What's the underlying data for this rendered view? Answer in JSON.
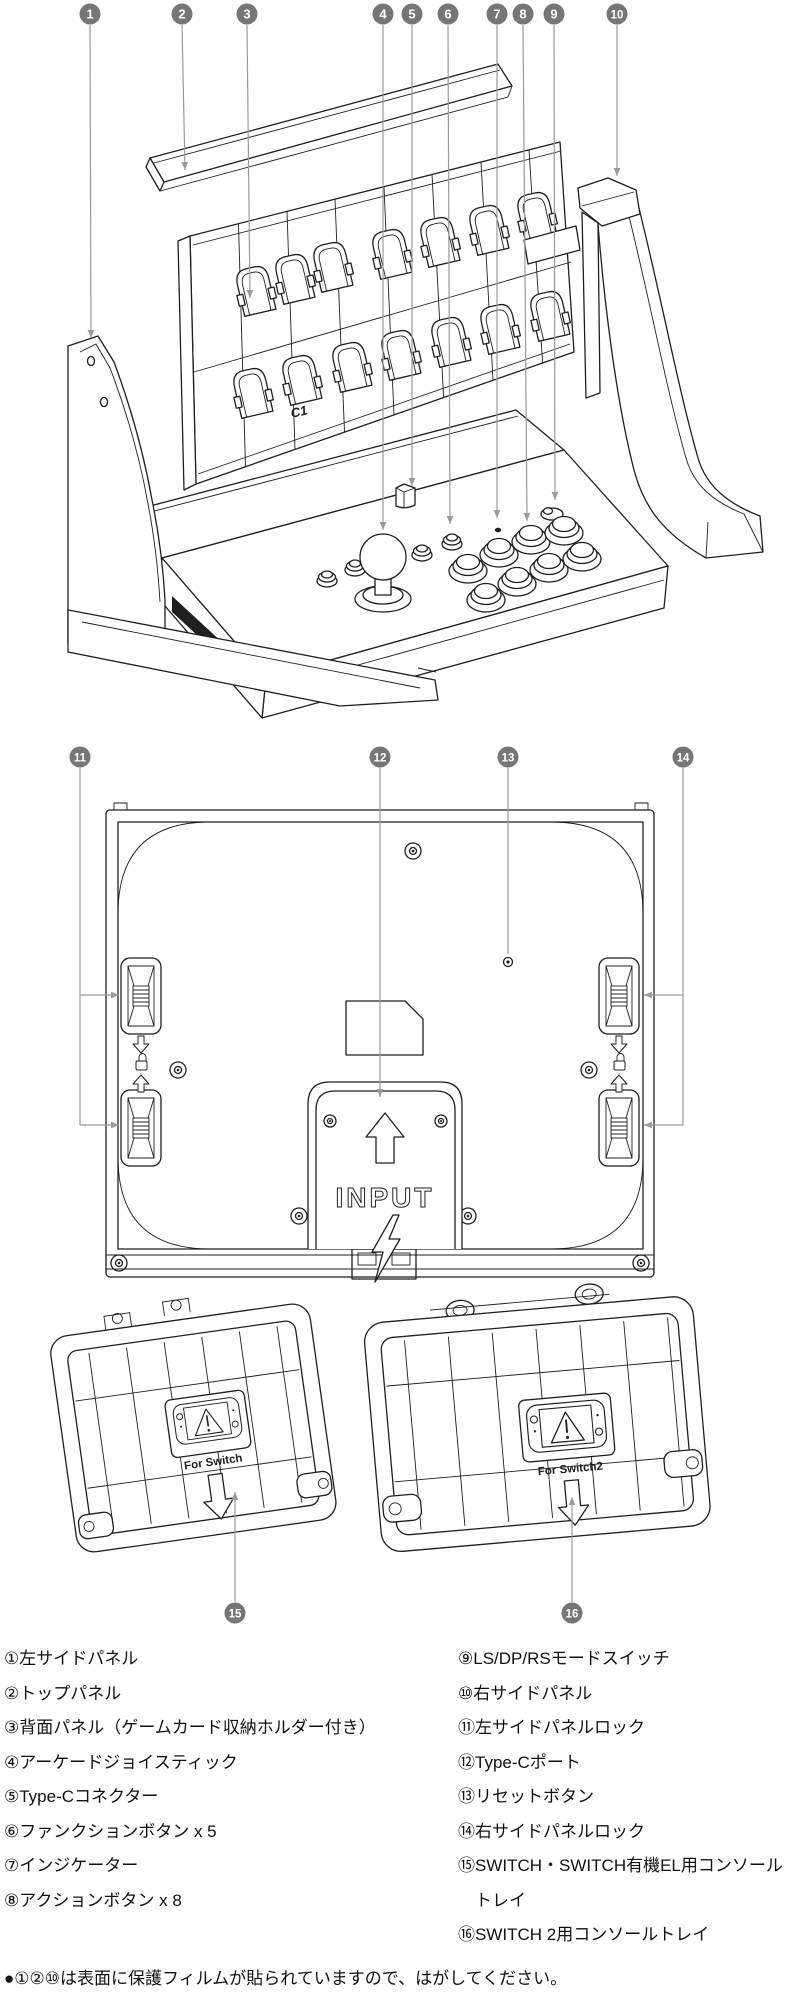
{
  "colors": {
    "ink": "#1f1f1f",
    "callout_fill": "#767676",
    "leader": "#9b9b9b",
    "bg": "#ffffff"
  },
  "fig_exploded": {
    "card_label": "C1",
    "callouts": [
      {
        "n": "1",
        "cx": 90,
        "cy": 14,
        "line": [
          [
            90,
            25
          ],
          [
            91,
            338
          ]
        ]
      },
      {
        "n": "2",
        "cx": 182,
        "cy": 14,
        "line": [
          [
            182,
            25
          ],
          [
            185,
            170
          ]
        ]
      },
      {
        "n": "3",
        "cx": 247,
        "cy": 14,
        "line": [
          [
            247,
            25
          ],
          [
            250,
            298
          ]
        ]
      },
      {
        "n": "4",
        "cx": 383,
        "cy": 14,
        "line": [
          [
            383,
            25
          ],
          [
            383,
            530
          ]
        ]
      },
      {
        "n": "5",
        "cx": 412,
        "cy": 14,
        "line": [
          [
            412,
            25
          ],
          [
            412,
            486
          ]
        ]
      },
      {
        "n": "6",
        "cx": 448,
        "cy": 14,
        "line": [
          [
            448,
            25
          ],
          [
            450,
            524
          ]
        ]
      },
      {
        "n": "7",
        "cx": 497,
        "cy": 14,
        "line": [
          [
            497,
            25
          ],
          [
            497,
            518
          ]
        ]
      },
      {
        "n": "8",
        "cx": 523,
        "cy": 14,
        "line": [
          [
            523,
            25
          ],
          [
            527,
            521
          ]
        ]
      },
      {
        "n": "9",
        "cx": 554,
        "cy": 14,
        "line": [
          [
            554,
            25
          ],
          [
            555,
            500
          ]
        ]
      },
      {
        "n": "10",
        "cx": 617,
        "cy": 14,
        "line": [
          [
            617,
            25
          ],
          [
            617,
            176
          ]
        ]
      }
    ]
  },
  "fig_back": {
    "input_label": "INPUT",
    "callouts": [
      {
        "n": "11",
        "cx": 80,
        "cy": 757,
        "line": [
          [
            80,
            768
          ],
          [
            80,
            1125
          ]
        ],
        "arrow": false,
        "branches": [
          [
            [
              80,
              995
            ],
            [
              119,
              995
            ]
          ],
          [
            [
              80,
              1125
            ],
            [
              119,
              1125
            ]
          ]
        ]
      },
      {
        "n": "12",
        "cx": 380,
        "cy": 757,
        "line": [
          [
            380,
            768
          ],
          [
            380,
            1097
          ]
        ]
      },
      {
        "n": "13",
        "cx": 508,
        "cy": 757,
        "line": [
          [
            508,
            768
          ],
          [
            508,
            954
          ]
        ],
        "arrow": false
      },
      {
        "n": "14",
        "cx": 683,
        "cy": 757,
        "line": [
          [
            683,
            768
          ],
          [
            683,
            1125
          ]
        ],
        "arrow": false,
        "branches": [
          [
            [
              683,
              995
            ],
            [
              644,
              995
            ]
          ],
          [
            [
              683,
              1125
            ],
            [
              644,
              1125
            ]
          ]
        ]
      }
    ]
  },
  "fig_trays": {
    "tray1_label": "For Switch",
    "tray2_label": "For Switch2",
    "callouts": [
      {
        "n": "15",
        "cx": 235,
        "cy": 1613,
        "line": [
          [
            235,
            1602
          ],
          [
            235,
            1492
          ]
        ]
      },
      {
        "n": "16",
        "cx": 572,
        "cy": 1613,
        "line": [
          [
            572,
            1602
          ],
          [
            572,
            1497
          ]
        ]
      }
    ]
  },
  "parts_list": {
    "left": [
      "①左サイドパネル",
      "②トップパネル",
      "③背面パネル（ゲームカード収納ホルダー付き）",
      "④アーケードジョイスティック",
      "⑤Type-Cコネクター",
      "⑥ファンクションボタン x 5",
      "⑦インジケーター",
      "⑧アクションボタン x 8"
    ],
    "right": [
      "⑨LS/DP/RSモードスイッチ",
      "⑩右サイドパネル",
      "⑪左サイドパネルロック",
      "⑫Type-Cポート",
      "⑬リセットボタン",
      "⑭右サイドパネルロック",
      "⑮SWITCH・SWITCH有機EL用コンソール",
      "　トレイ",
      "⑯SWITCH 2用コンソールトレイ"
    ],
    "note": "●①②⑩は表面に保護フィルムが貼られていますので、はがしてください。"
  }
}
